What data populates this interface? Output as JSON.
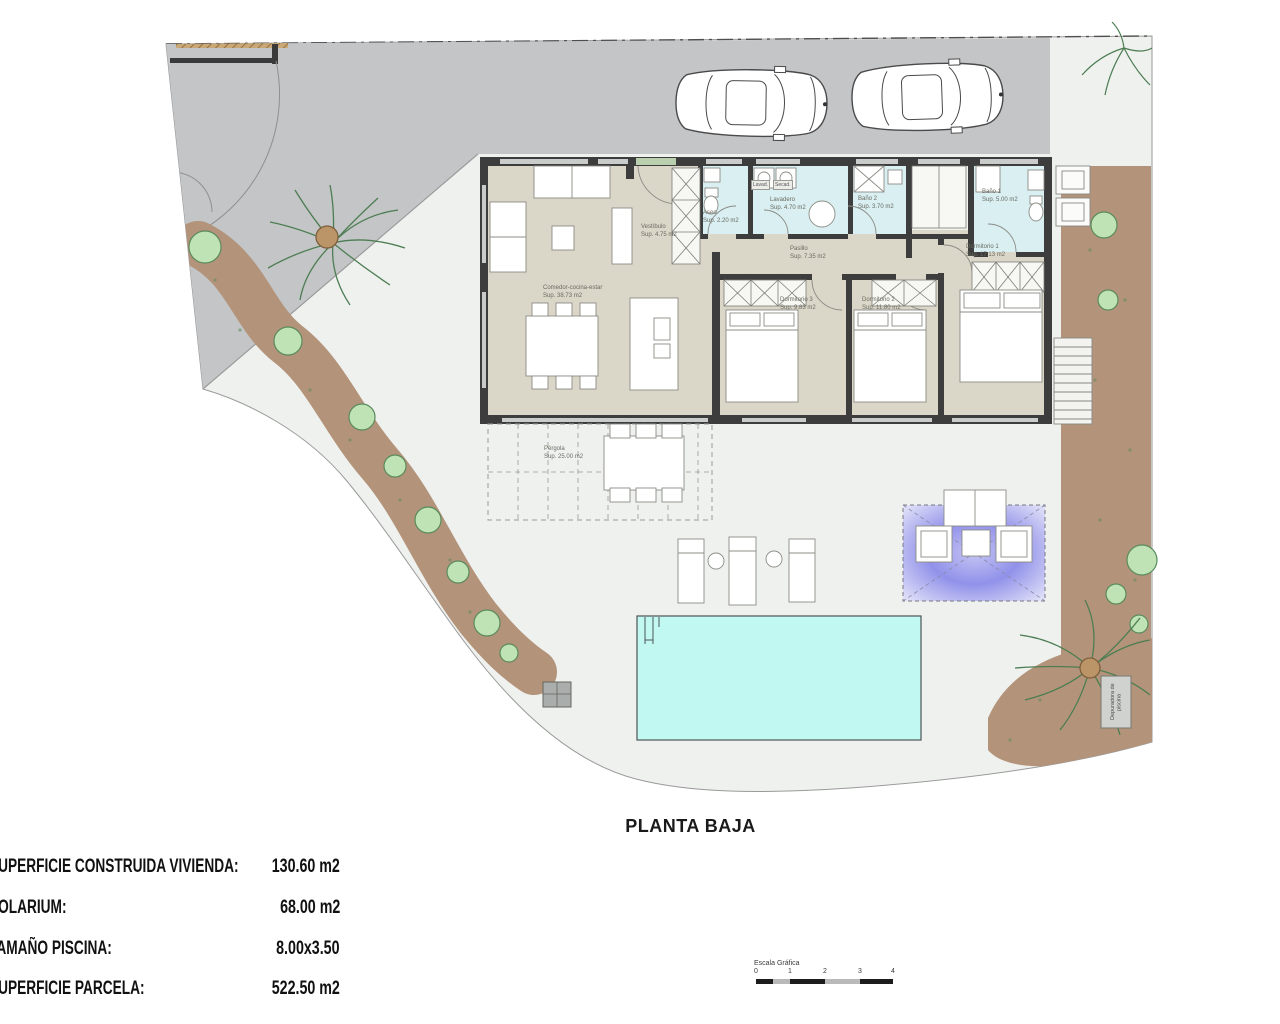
{
  "title": "PLANTA BAJA",
  "plan": {
    "rooms": [
      {
        "name": "Comedor-cocina-estar",
        "area": "Sup. 38.73 m2"
      },
      {
        "name": "Vestíbulo",
        "area": "Sup. 4.75 m2"
      },
      {
        "name": "Aseo",
        "area": "Sup. 2.20 m2"
      },
      {
        "name": "Lavadero",
        "area": "Sup. 4.70 m2"
      },
      {
        "name": "Baño 2",
        "area": "Sup. 3.70 m2"
      },
      {
        "name": "Baño 1",
        "area": "Sup. 5.00 m2"
      },
      {
        "name": "Pasillo",
        "area": "Sup. 7.35 m2"
      },
      {
        "name": "Dormitorio 3",
        "area": "Sup. 9.83 m2"
      },
      {
        "name": "Dormitorio 2",
        "area": "Sup. 11.80 m2"
      },
      {
        "name": "Dormitorio 1",
        "area": "Sup. 17.13 m2"
      },
      {
        "name": "Pérgola",
        "area": "Sup. 25.00 m2"
      }
    ],
    "appliance_labels": [
      {
        "label": "Lavad."
      },
      {
        "label": "Secad."
      }
    ],
    "equipment_label": "Depuradora de piscina"
  },
  "summary": {
    "items": [
      {
        "label": "SUPERFICIE CONSTRUIDA VIVIENDA:",
        "value": "130.60 m2"
      },
      {
        "label": "SOLARIUM:",
        "value": "68.00 m2"
      },
      {
        "label": "TAMAÑO PISCINA:",
        "value": "8.00x3.50"
      },
      {
        "label": "SUPERFICIE PARCELA:",
        "value": "522.50 m2"
      }
    ]
  },
  "scalebar": {
    "title": "Escala Gráfica",
    "ticks": [
      "0",
      "1",
      "2",
      "3",
      "4"
    ]
  },
  "colors": {
    "pool": "#c2f8f2",
    "driveway": "#c3c5c7",
    "garden": "#b3947a",
    "house_floor": "#dad6c8",
    "wet_room": "#d9eff2",
    "wall": "#3d3d3d",
    "lounge_area": "#8f8fe8",
    "patio": "#eff1ef"
  }
}
